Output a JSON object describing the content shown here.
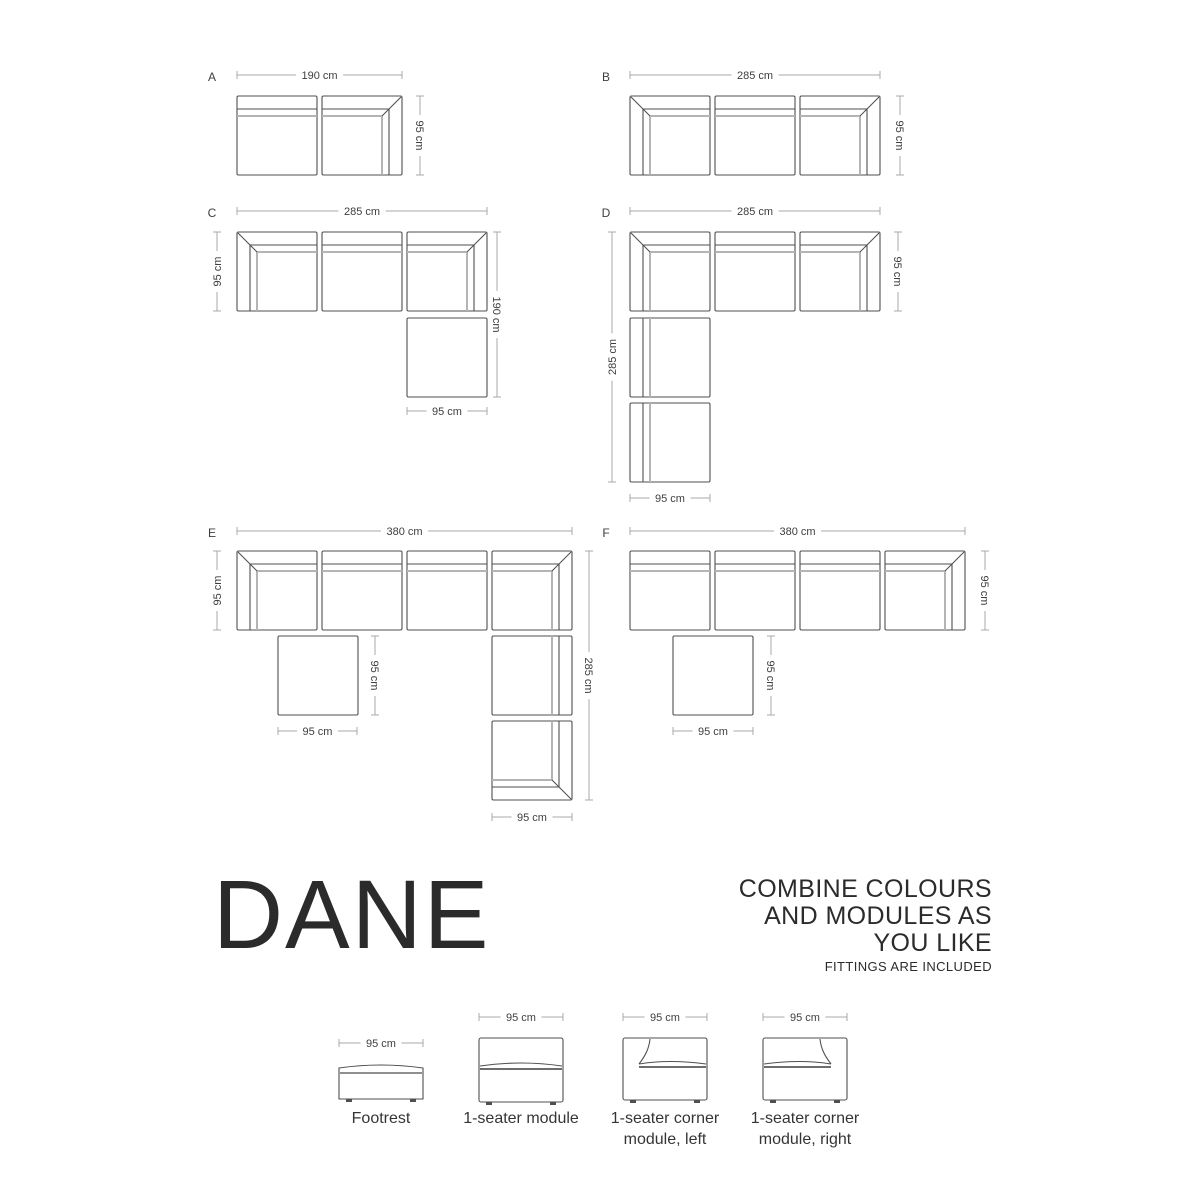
{
  "title": "DANE",
  "tagline": "COMBINE COLOURS\nAND MODULES AS\nYOU LIKE",
  "tagline_note": "FITTINGS ARE INCLUDED",
  "colors": {
    "outline": "#4f4f4f",
    "soft_line": "#b4b4b4",
    "dim_line": "#a8a8a8",
    "dim_text": "#3e3e3e",
    "letter_text": "#3e3e3e"
  },
  "module_px": {
    "w": 80,
    "h": 79
  },
  "configurations": [
    {
      "label": "A",
      "label_pos": [
        212,
        81
      ],
      "modules": [
        {
          "type": "T",
          "x": 237,
          "y": 96
        },
        {
          "type": "TR",
          "x": 322,
          "y": 96
        }
      ],
      "dims": [
        {
          "o": "h",
          "x": 237,
          "y": 75,
          "len": 165,
          "label": "190 cm"
        },
        {
          "o": "v",
          "x": 420,
          "y": 96,
          "len": 79,
          "label": "95 cm",
          "rot": 90
        }
      ]
    },
    {
      "label": "B",
      "label_pos": [
        606,
        81
      ],
      "modules": [
        {
          "type": "TL",
          "x": 630,
          "y": 96
        },
        {
          "type": "T",
          "x": 715,
          "y": 96
        },
        {
          "type": "TR",
          "x": 800,
          "y": 96
        }
      ],
      "dims": [
        {
          "o": "h",
          "x": 630,
          "y": 75,
          "len": 250,
          "label": "285 cm"
        },
        {
          "o": "v",
          "x": 900,
          "y": 96,
          "len": 79,
          "label": "95 cm",
          "rot": 90
        }
      ]
    },
    {
      "label": "C",
      "label_pos": [
        212,
        217
      ],
      "modules": [
        {
          "type": "TL",
          "x": 237,
          "y": 232
        },
        {
          "type": "T",
          "x": 322,
          "y": 232
        },
        {
          "type": "TR",
          "x": 407,
          "y": 232
        },
        {
          "type": "F",
          "x": 407,
          "y": 318
        }
      ],
      "dims": [
        {
          "o": "h",
          "x": 237,
          "y": 211,
          "len": 250,
          "label": "285 cm"
        },
        {
          "o": "v",
          "x": 217,
          "y": 232,
          "len": 79,
          "label": "95 cm",
          "rot": -90
        },
        {
          "o": "v",
          "x": 497,
          "y": 232,
          "len": 165,
          "label": "190 cm",
          "rot": 90
        },
        {
          "o": "h",
          "x": 407,
          "y": 411,
          "len": 80,
          "label": "95 cm"
        }
      ]
    },
    {
      "label": "D",
      "label_pos": [
        606,
        217
      ],
      "modules": [
        {
          "type": "TL",
          "x": 630,
          "y": 232
        },
        {
          "type": "T",
          "x": 715,
          "y": 232
        },
        {
          "type": "TR",
          "x": 800,
          "y": 232
        },
        {
          "type": "L",
          "x": 630,
          "y": 318
        },
        {
          "type": "L",
          "x": 630,
          "y": 403
        }
      ],
      "dims": [
        {
          "o": "h",
          "x": 630,
          "y": 211,
          "len": 250,
          "label": "285 cm"
        },
        {
          "o": "v",
          "x": 898,
          "y": 232,
          "len": 79,
          "label": "95 cm",
          "rot": 90
        },
        {
          "o": "v",
          "x": 612,
          "y": 232,
          "len": 250,
          "label": "285 cm",
          "rot": -90
        },
        {
          "o": "h",
          "x": 630,
          "y": 498,
          "len": 80,
          "label": "95 cm"
        }
      ]
    },
    {
      "label": "E",
      "label_pos": [
        212,
        537
      ],
      "modules": [
        {
          "type": "TL",
          "x": 237,
          "y": 551
        },
        {
          "type": "T",
          "x": 322,
          "y": 551
        },
        {
          "type": "T",
          "x": 407,
          "y": 551
        },
        {
          "type": "TR",
          "x": 492,
          "y": 551
        },
        {
          "type": "F",
          "x": 278,
          "y": 636
        },
        {
          "type": "R",
          "x": 492,
          "y": 636
        },
        {
          "type": "BR",
          "x": 492,
          "y": 721
        }
      ],
      "dims": [
        {
          "o": "h",
          "x": 237,
          "y": 531,
          "len": 335,
          "label": "380 cm"
        },
        {
          "o": "v",
          "x": 217,
          "y": 551,
          "len": 79,
          "label": "95 cm",
          "rot": -90
        },
        {
          "o": "v",
          "x": 375,
          "y": 636,
          "len": 79,
          "label": "95 cm",
          "rot": 90
        },
        {
          "o": "h",
          "x": 278,
          "y": 731,
          "len": 79,
          "label": "95 cm"
        },
        {
          "o": "v",
          "x": 589,
          "y": 551,
          "len": 249,
          "label": "285 cm",
          "rot": 90
        },
        {
          "o": "h",
          "x": 492,
          "y": 817,
          "len": 80,
          "label": "95 cm"
        }
      ]
    },
    {
      "label": "F",
      "label_pos": [
        606,
        537
      ],
      "modules": [
        {
          "type": "T",
          "x": 630,
          "y": 551
        },
        {
          "type": "T",
          "x": 715,
          "y": 551
        },
        {
          "type": "T",
          "x": 800,
          "y": 551
        },
        {
          "type": "TR",
          "x": 885,
          "y": 551
        },
        {
          "type": "F",
          "x": 673,
          "y": 636
        }
      ],
      "dims": [
        {
          "o": "h",
          "x": 630,
          "y": 531,
          "len": 335,
          "label": "380 cm"
        },
        {
          "o": "v",
          "x": 985,
          "y": 551,
          "len": 79,
          "label": "95 cm",
          "rot": 90
        },
        {
          "o": "v",
          "x": 771,
          "y": 636,
          "len": 79,
          "label": "95 cm",
          "rot": 90
        },
        {
          "o": "h",
          "x": 673,
          "y": 731,
          "len": 80,
          "label": "95 cm"
        }
      ]
    }
  ],
  "legend": {
    "items": [
      {
        "kind": "footrest",
        "label": "Footrest",
        "dim_label": "95 cm",
        "x": 339,
        "y": 1063,
        "w": 84,
        "h": 36,
        "dim_y": 1043,
        "cx": 381
      },
      {
        "kind": "seat",
        "label": "1-seater module",
        "dim_label": "95 cm",
        "x": 479,
        "y": 1038,
        "w": 84,
        "h": 64,
        "dim_y": 1017,
        "cx": 521
      },
      {
        "kind": "corner-left",
        "label": "1-seater corner\nmodule, left",
        "dim_label": "95 cm",
        "x": 623,
        "y": 1038,
        "w": 84,
        "h": 62,
        "dim_y": 1017,
        "cx": 665
      },
      {
        "kind": "corner-right",
        "label": "1-seater corner\nmodule, right",
        "dim_label": "95 cm",
        "x": 763,
        "y": 1038,
        "w": 84,
        "h": 62,
        "dim_y": 1017,
        "cx": 805
      }
    ]
  }
}
